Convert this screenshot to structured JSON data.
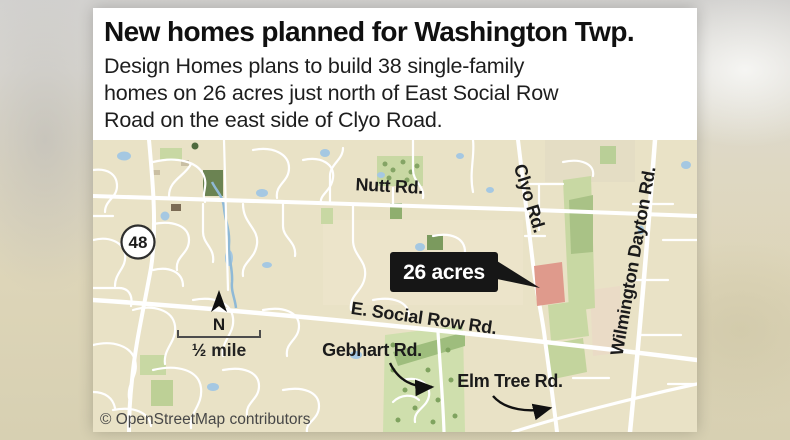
{
  "header": {
    "title": "New homes planned for Washington Twp.",
    "subtitle_lines": [
      "Design Homes plans to build 38 single-family",
      "homes on 26 acres just north of East Social Row",
      "Road on the east side of Clyo Road."
    ]
  },
  "map": {
    "road_labels": {
      "nutt": "Nutt Rd.",
      "clyo": "Clyo Rd.",
      "wilmington_dayton": "Wilmington Dayton Rd.",
      "e_social_row": "E. Social Row Rd.",
      "gebhart": "Gebhart Rd.",
      "elm_tree": "Elm Tree Rd."
    },
    "route_shield": "48",
    "callout_label": "26 acres",
    "compass_label": "N",
    "scale_label": "½ mile",
    "attribution": "© OpenStreetMap contributors",
    "colors": {
      "land": "#e9e2c6",
      "road": "#ffffff",
      "green_light": "#c8d8a3",
      "green_dark": "#6b8352",
      "water": "#a5c8e2",
      "parcel": "#df9a8c",
      "callout_bg": "#161616",
      "callout_text": "#ffffff"
    }
  }
}
